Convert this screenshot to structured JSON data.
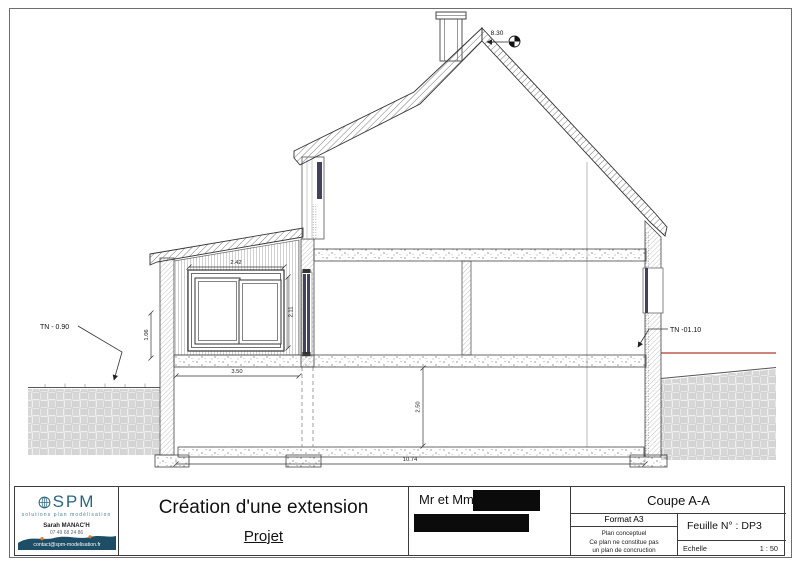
{
  "drawing": {
    "annotations": {
      "ridge_level": "8.30",
      "tn_left": "TN - 0.90",
      "tn_right": "TN -01.10"
    },
    "dimensions": {
      "window_width": "2.42",
      "window_height": "2.11",
      "cladding_height": "1.06",
      "extension_width": "3.50",
      "basement_height": "2.50",
      "total_width": "10.74"
    },
    "colors": {
      "terrain_line_red": "#b23b2a",
      "glazing_navy": "#44415f"
    }
  },
  "title_block": {
    "company_card": {
      "brand": "SPM",
      "tagline": "solutions  plan  modélisation",
      "contact_name": "Sarah MANAC'H",
      "phone": "07 49 68 24 86",
      "email": "contact@spm-modelisation.fr"
    },
    "project_title": "Création d'une extension",
    "project_subtitle": "Projet",
    "client_prefix": "Mr et Mme",
    "view_title": "Coupe A-A",
    "format_label": "Format A3",
    "disclaimer": [
      "Plan conceptuel",
      "Ce plan ne constitue pas",
      "un plan de concruction"
    ],
    "sheet_label": "Feuille N° : DP3",
    "scale_label": "Echelle",
    "scale_value": "1 : 50"
  }
}
